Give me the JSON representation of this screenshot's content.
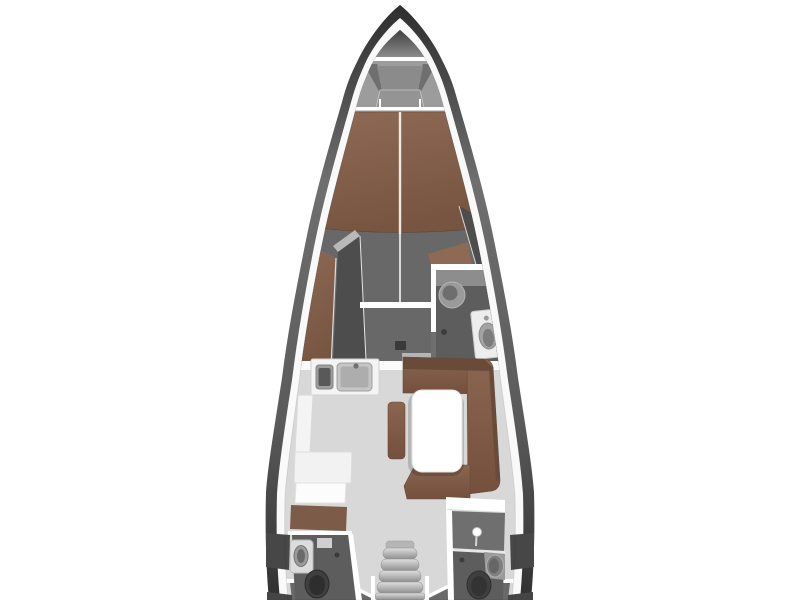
{
  "image": {
    "kind": "yacht-interior-floorplan",
    "view": "top-down"
  },
  "colors": {
    "background": "#ffffff",
    "hull_band": "#f9f9f9",
    "deck": "#9c9c9c",
    "anchor_locker": "#373737",
    "cabin_floor": "#686868",
    "head_floor": "#5d5d5d",
    "aft_floor": "#696969",
    "salon_floor": "#d8d8d8",
    "upholstery": "#7d5b49",
    "upholstery_light": "#8e6a55",
    "upholstery_dark": "#6a4a39",
    "furniture_dark": "#4d4d4d",
    "furniture_mid": "#8f8f8f",
    "counter": "#f4f4f4",
    "table": "#ffffff",
    "fixture": "#9a9a9a",
    "toilet_dark": "#3f3f3f",
    "line_white": "#ffffff",
    "centerline": "#efe9e3",
    "locker_segment": "#474747"
  },
  "parts": {
    "anchor_locker": "anchor locker",
    "foredeck": "foredeck V with molded seat",
    "v_berth": "forward cabin V-berth",
    "port_chaise": "port berth extension",
    "wardrobe": "port wardrobe",
    "forward_head": "forward head with sink and toilet",
    "starboard_locker": "starboard hull locker",
    "galley": "galley with double sink and L-counter",
    "settee": "U-shaped salon settee",
    "salon_table": "salon table",
    "ottoman": "salon ottoman bench",
    "companionway": "companionway stairs",
    "port_aft_head": "port aft head with sink and toilet",
    "starboard_aft_head": "starboard aft head with shower, sink and toilet"
  }
}
